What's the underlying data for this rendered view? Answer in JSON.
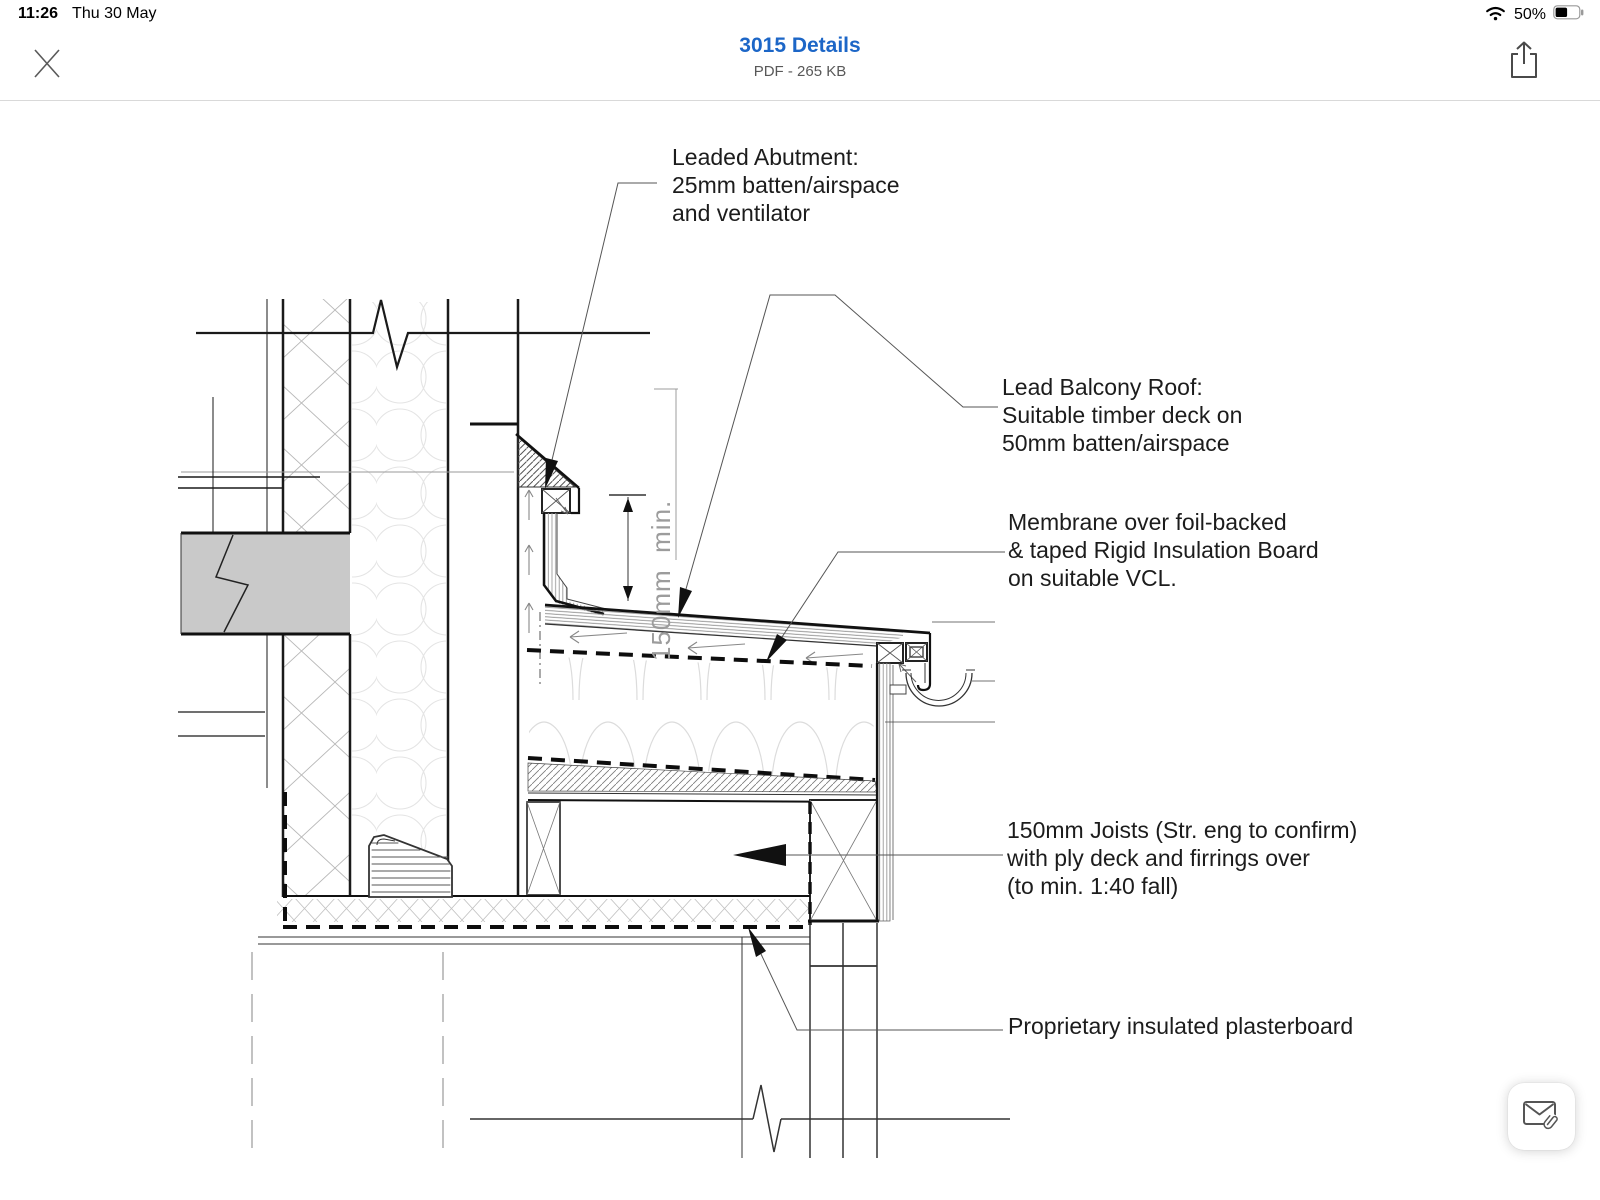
{
  "status_bar": {
    "time": "11:26",
    "date": "Thu 30 May",
    "battery_percent": "50%"
  },
  "nav_bar": {
    "title": "3015 Details",
    "subtitle": "PDF - 265 KB",
    "title_color": "#1c66c7"
  },
  "annotations": [
    {
      "lines": [
        "Leaded Abutment:",
        "25mm batten/airspace",
        "and ventilator"
      ]
    },
    {
      "lines": [
        "Lead Balcony Roof:",
        "Suitable timber deck on",
        "50mm batten/airspace"
      ]
    },
    {
      "lines": [
        "Membrane over foil-backed",
        "& taped Rigid Insulation Board",
        "on suitable VCL."
      ]
    },
    {
      "lines": [
        "150mm Joists (Str. eng to confirm)",
        "with ply deck and firrings over",
        "(to min. 1:40 fall)"
      ]
    },
    {
      "lines": [
        "Proprietary insulated plasterboard"
      ]
    }
  ],
  "dimension": {
    "label": "150mm  min."
  },
  "icons": {
    "close": "close-icon",
    "share": "share-icon",
    "wifi": "wifi-icon",
    "battery": "battery-half-icon",
    "floating_button": "email-attachment-icon"
  },
  "colors": {
    "accent_blue": "#1c66c7",
    "line_dark": "#1a1a1a",
    "beam_gray": "#c9c9c9"
  }
}
